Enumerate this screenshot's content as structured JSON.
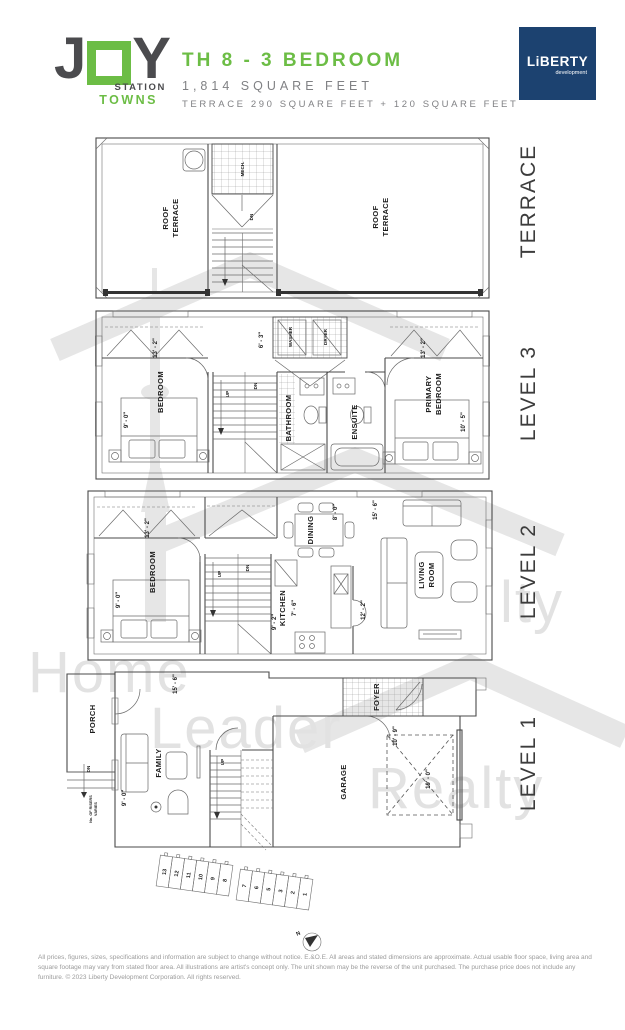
{
  "header": {
    "logo_j": "J",
    "logo_y": "Y",
    "logo_station": "STATION",
    "logo_towns": "TOWNS",
    "title": "TH 8 - 3 BEDROOM",
    "area": "1,814 SQUARE FEET",
    "terrace_area": "TERRACE 290 SQUARE FEET + 120 SQUARE FEET",
    "developer_name": "LiBERTY",
    "developer_sub": "development"
  },
  "side_labels": {
    "terrace": "TERRACE",
    "level3": "LEVEL 3",
    "level2": "LEVEL 2",
    "level1": "LEVEL 1"
  },
  "plans": {
    "terrace": {
      "roof_line1": "ROOF",
      "roof_line2": "TERRACE",
      "mech": "MECH.",
      "dn": "DN"
    },
    "level3": {
      "bedroom": "BEDROOM",
      "bedroom_width": "13' - 2\"",
      "bedroom_depth": "9' - 0\"",
      "up": "UP",
      "dn": "DN",
      "laundry_width": "6' - 3\"",
      "washer": "WASHER",
      "dryer": "DRYER",
      "bathroom": "BATHROOM",
      "ensuite": "ENSUITE",
      "primary_line1": "PRIMARY",
      "primary_line2": "BEDROOM",
      "primary_width": "13' - 2\"",
      "primary_depth": "10' - 5\""
    },
    "level2": {
      "bedroom": "BEDROOM",
      "bedroom_width": "13' - 2\"",
      "bedroom_depth": "9' - 0\"",
      "up": "UP",
      "dn": "DN",
      "dining": "DINING",
      "dining_width": "8' - 0\"",
      "living_width": "15' - 6\"",
      "living_line1": "LIVING",
      "living_line2": "ROOM",
      "living_depth": "12' - 2\"",
      "kitchen": "KITCHEN",
      "kitchen_depth": "7' - 6\"",
      "kitchen_width": "9' - 2\""
    },
    "level1": {
      "porch": "PORCH",
      "dn": "DN",
      "risers_line1": "No. OF RISERS",
      "risers_line2": "VARIES",
      "family": "FAMILY",
      "family_width": "15' - 6\"",
      "family_depth": "9' - 0\"",
      "up": "UP",
      "foyer": "FOYER",
      "garage": "GARAGE",
      "garage_width": "10' - 9\"",
      "garage_depth": "19' - 0\""
    }
  },
  "keyplan": {
    "left_units": [
      "13",
      "12",
      "11",
      "10",
      "9",
      "8"
    ],
    "right_units": [
      "7",
      "6",
      "5",
      "3",
      "2",
      "1"
    ],
    "north_label": "N"
  },
  "watermark": {
    "word1": "Home",
    "word2": "Leader",
    "word3": "Realty",
    "partial": "lty"
  },
  "footer": {
    "disclaimer": "All prices, figures, sizes, specifications and information are subject to change without notice. E.&O.E. All areas and stated dimensions are approximate. Actual usable floor space, living area and square footage may vary from stated floor area. All illustrations are artist's concept only. The unit shown may be the reverse of the unit purchased. The purchase price does not include any furniture. © 2023 Liberty Development Corporation. All rights reserved."
  },
  "colors": {
    "brand_green": "#6cbd45",
    "brand_navy": "#1c4270",
    "logo_gray": "#4b4b4e",
    "text_gray": "#808184",
    "line_gray": "#4a4a4a",
    "watermark_gray": "#e2e2e2",
    "highlight_unit_gray": "#b3b3b3"
  }
}
